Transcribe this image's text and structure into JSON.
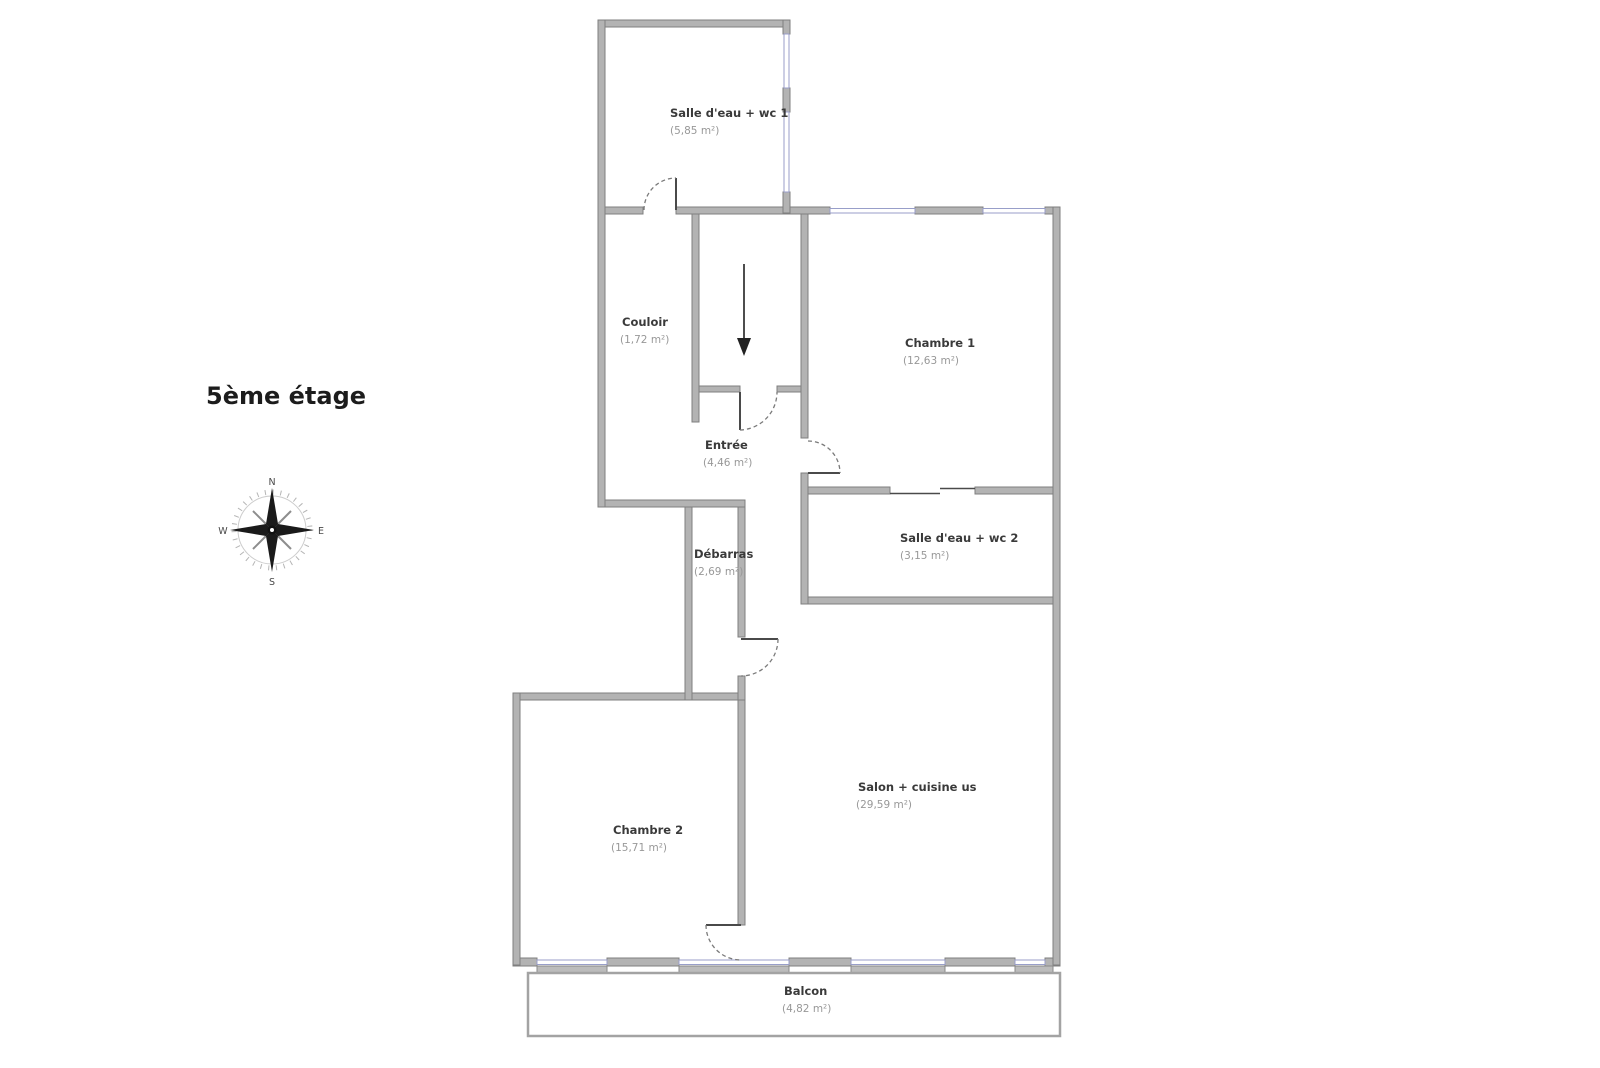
{
  "title": "5ème étage",
  "compass": {
    "n": "N",
    "e": "E",
    "s": "S",
    "w": "W"
  },
  "rooms": {
    "bathroom1": {
      "name": "Salle d'eau + wc 1",
      "area": "(5,85 m²)"
    },
    "couloir": {
      "name": "Couloir",
      "area": "(1,72 m²)"
    },
    "chambre1": {
      "name": "Chambre 1",
      "area": "(12,63 m²)"
    },
    "entree": {
      "name": "Entrée",
      "area": "(4,46 m²)"
    },
    "bathroom2": {
      "name": "Salle d'eau + wc 2",
      "area": "(3,15 m²)"
    },
    "debarras": {
      "name": "Débarras",
      "area": "(2,69 m²)"
    },
    "salon": {
      "name": "Salon + cuisine us",
      "area": "(29,59 m²)"
    },
    "chambre2": {
      "name": "Chambre 2",
      "area": "(15,71 m²)"
    },
    "balcon": {
      "name": "Balcon",
      "area": "(4,82 m²)"
    }
  },
  "colors": {
    "wall": "#b3b3b3",
    "wall_edge": "#7f7f7f",
    "window": "#989ec9",
    "room_name_text": "#3a3a3a",
    "room_area_text": "#989898",
    "title_text": "#1c1c1c"
  }
}
